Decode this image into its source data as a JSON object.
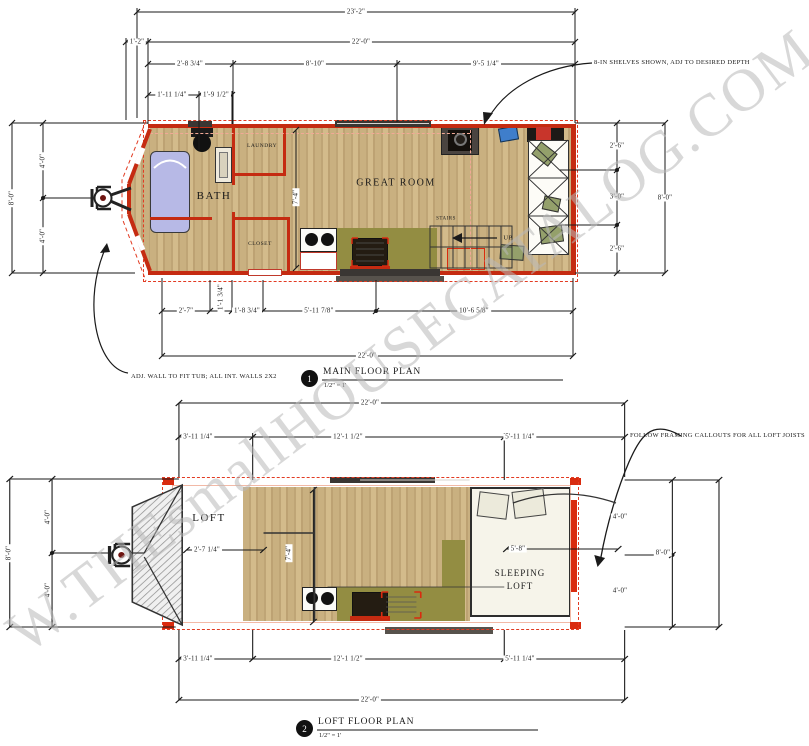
{
  "sheet": {
    "watermark": "W.THEsmallHOUSECATALOG.COM"
  },
  "colors": {
    "wall_red": "#c52b11",
    "bright_red": "#d92b0f",
    "dashed_outline_red": "#e23b22",
    "floor_wood": "#c9b080",
    "counter_olive": "#938d42",
    "tub_lavender": "#b7b9e6",
    "roof_hatch_gray": "#8f8f8f",
    "watermark_gray": "#b9b9b9"
  },
  "main_plan": {
    "callout_number": "1",
    "title": "MAIN FLOOR PLAN",
    "scale": "1/2\" = 1'",
    "rooms": {
      "bath": "BATH",
      "laundry": "LAUNDRY",
      "closet": "CLOSET",
      "great_room": "GREAT ROOM",
      "stairs": "STAIRS",
      "up_label": "UP"
    },
    "annotations": {
      "shelves": "8-IN SHELVES SHOWN, ADJ TO DESIRED DEPTH",
      "tub_wall": "ADJ. WALL TO FIT TUB; ALL INT. WALLS 2X2"
    },
    "dims": {
      "overall_width": "23'-2\"",
      "body_width_top": "22'-0\"",
      "hitch_offset": "1'-2\"",
      "seg_bath": "2'-8 3/4\"",
      "seg_mid": "8'-10\"",
      "seg_right": "9'-5 1/4\"",
      "tub_a": "1'-11 1/4\"",
      "tub_b": "1'-9 1/2\"",
      "left_total": "8'-0\"",
      "left_a": "4'-0\"",
      "left_b": "4'-0\"",
      "right_a": "2'-6\"",
      "right_b": "3'-0\"",
      "right_c": "2'-6\"",
      "right_total": "8'-0\"",
      "hall_depth": "7'-4\"",
      "bot_a": "2'-7\"",
      "bot_b": "1'-1 3/4\"",
      "bot_c": "1'-8 3/4\"",
      "bot_d": "5'-11 7/8\"",
      "bot_e": "10'-6 5/8\"",
      "body_width_bottom": "22'-0\""
    }
  },
  "loft_plan": {
    "callout_number": "2",
    "title": "LOFT FLOOR PLAN",
    "scale": "1/2\" = 1'",
    "rooms": {
      "loft": "LOFT",
      "sleeping_line1": "SLEEPING",
      "sleeping_line2": "LOFT"
    },
    "annotations": {
      "framing": "FOLLOW FRAMING CALLOUTS FOR ALL LOFT JOISTS"
    },
    "dims": {
      "top_total": "22'-0\"",
      "top_a": "3'-11 1/4\"",
      "top_b": "12'-1 1/2\"",
      "top_c": "5'-11 1/4\"",
      "left_total": "8'-0\"",
      "left_a": "4'-0\"",
      "left_b": "4'-0\"",
      "right_a": "4'-0\"",
      "right_b": "4'-0\"",
      "right_total": "8'-0\"",
      "loft_depth": "2'-7 1/4\"",
      "open_depth": "7'-4\"",
      "bed_width": "5'-8\"",
      "bot_a": "3'-11 1/4\"",
      "bot_b": "12'-1 1/2\"",
      "bot_c": "5'-11 1/4\"",
      "bot_total": "22'-0\""
    }
  }
}
